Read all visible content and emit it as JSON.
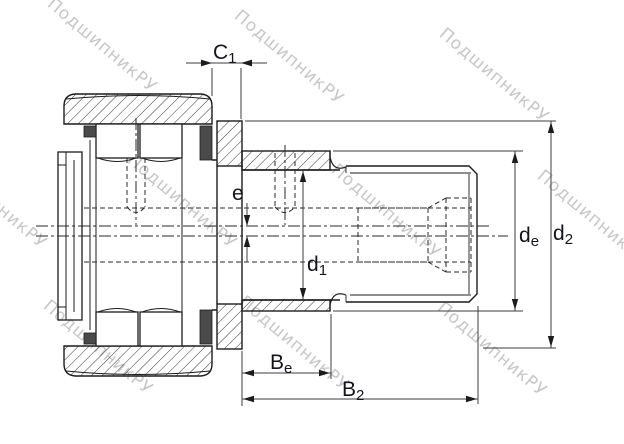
{
  "watermark": {
    "text": "ПодшипникРУ",
    "color": "#c7c7c7"
  },
  "colors": {
    "outline": "#1c1c1c",
    "dimension_line": "#3c3c3c",
    "label": "#14141c",
    "seal_fill": "#4a4a4a",
    "background": "#ffffff"
  },
  "dimensions": {
    "c1": {
      "base": "C",
      "sub": "1"
    },
    "e": {
      "base": "e",
      "sub": ""
    },
    "d1": {
      "base": "d",
      "sub": "1"
    },
    "de": {
      "base": "d",
      "sub": "e"
    },
    "d2": {
      "base": "d",
      "sub": "2"
    },
    "be": {
      "base": "B",
      "sub": "e"
    },
    "b2": {
      "base": "B",
      "sub": "2"
    }
  }
}
